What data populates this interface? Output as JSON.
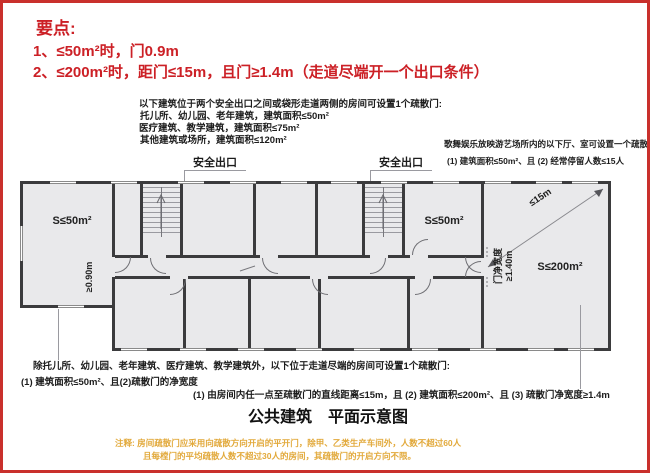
{
  "frame": {
    "border_color": "#c9302c",
    "background": "#ffffff"
  },
  "key_points": {
    "heading": "要点:",
    "item1": "1、≤50m²时，门0.9m",
    "item2": "2、≤200m²时，距门≤15m，且门≥1.4m（走道尽端开一个出口条件）",
    "color": "#cc2026"
  },
  "rule_two_exits": {
    "line1": "以下建筑位于两个安全出口之间或袋形走道两侧的房间可设置1个疏散门:",
    "line2": "托儿所、幼儿园、老年建筑，建筑面积≤50m²",
    "line3": "医疗建筑、教学建筑，建筑面积≤75m²",
    "line4": "其他建筑或场所，建筑面积≤120m²"
  },
  "exit_label_left": "安全出口",
  "exit_label_right": "安全出口",
  "rule_entertainment": {
    "line1": "歌舞娱乐放映游艺场所内的以下厅、室可设置一个疏散门:",
    "line2": "(1) 建筑面积≤50m²、且 (2) 经常停留人数≤15人"
  },
  "plan": {
    "room_left_label": "S≤50m²",
    "room_mid_label": "S≤50m²",
    "room_right_label": "S≤200m²",
    "door_left_width": "≥0.90m",
    "door_right_label_1": "门净宽度",
    "door_right_label_2": "≥1.40m",
    "diagonal_label": "≤15m"
  },
  "rule_dead_end": {
    "line1": "除托儿所、幼儿园、老年建筑、医疗建筑、教学建筑外，以下位于走道尽端的房间可设置1个疏散门:",
    "line2": "(1) 建筑面积≤50m²、且(2)疏散门的净宽度",
    "line3": "(1) 由房间内任一点至疏散门的直线距离≤15m，且 (2) 建筑面积≤200m²、且 (3) 疏散门净宽度≥1.4m"
  },
  "caption": "公共建筑　平面示意图",
  "footnote": {
    "line1": "注释: 房间疏散门应采用向疏散方向开启的平开门，除甲、乙类生产车间外，人数不超过60人",
    "line2": "且每樘门的平均疏散人数不超过30人的房间，其疏散门的开启方向不限。",
    "color": "#e2a93b"
  }
}
